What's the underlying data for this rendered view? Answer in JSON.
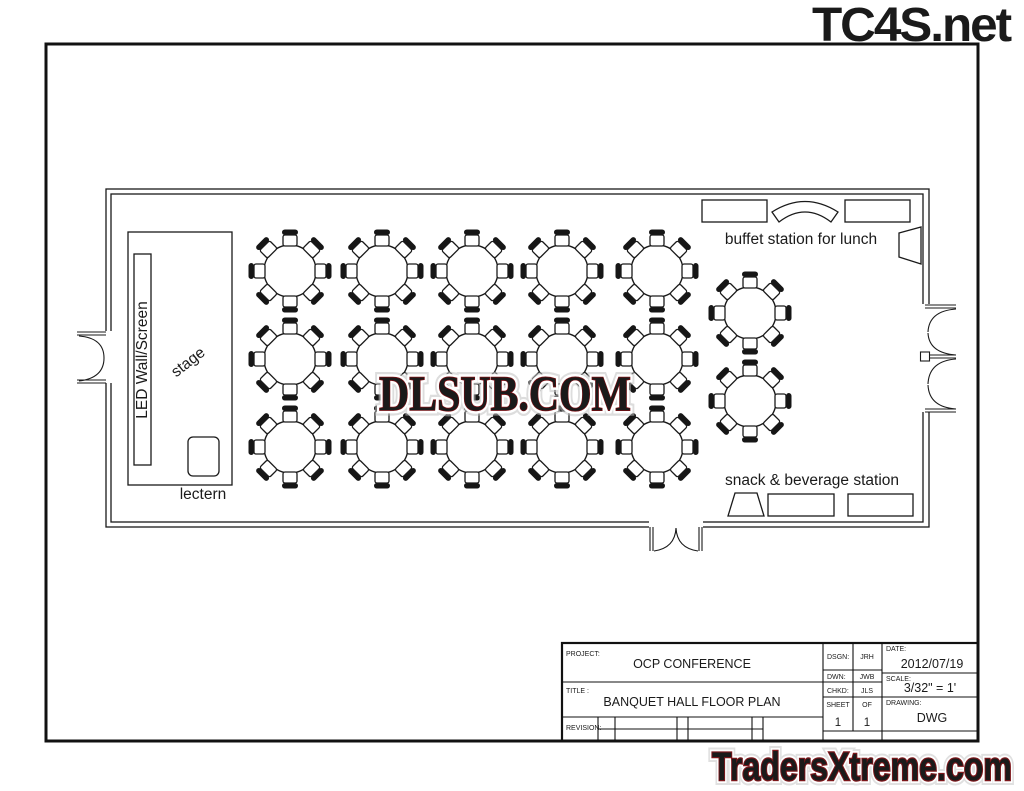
{
  "watermarks": {
    "top_right": "TC4S.net",
    "center": "DLSUB.COM",
    "bottom_right": "TradersXtreme.com"
  },
  "floor_plan": {
    "labels": {
      "led_wall": "LED Wall/Screen",
      "stage": "stage",
      "lectern": "lectern",
      "buffet": "buffet station for lunch",
      "snack": "snack & beverage station"
    },
    "tables": {
      "cols": [
        290,
        382,
        472,
        562,
        657
      ],
      "rows": [
        271,
        359,
        447
      ],
      "extra": [
        {
          "x": 750,
          "y": 313
        },
        {
          "x": 750,
          "y": 401
        }
      ],
      "seats_per_table": 8,
      "table_count": 17
    }
  },
  "title_block": {
    "project_label": "PROJECT:",
    "project": "OCP CONFERENCE",
    "title_label": "TITLE :",
    "title": "BANQUET HALL FLOOR PLAN",
    "revision_label": "REVISION:",
    "dsgn_label": "DSGN:",
    "dsgn": "JRH",
    "dwn_label": "DWN:",
    "dwn": "JWB",
    "chkd_label": "CHKD:",
    "chkd": "JLS",
    "sheet_label": "SHEET",
    "of_label": "OF",
    "sheet_no": "1",
    "of_no": "1",
    "date_label": "DATE:",
    "date": "2012/07/19",
    "scale_label": "SCALE:",
    "scale": "3/32\" = 1'",
    "drawing_label": "DRAWING:",
    "drawing": "DWG"
  },
  "colors": {
    "line": "#1a1a1a",
    "watermark_red": "#c41e24",
    "traders_red": "#db6a62"
  }
}
